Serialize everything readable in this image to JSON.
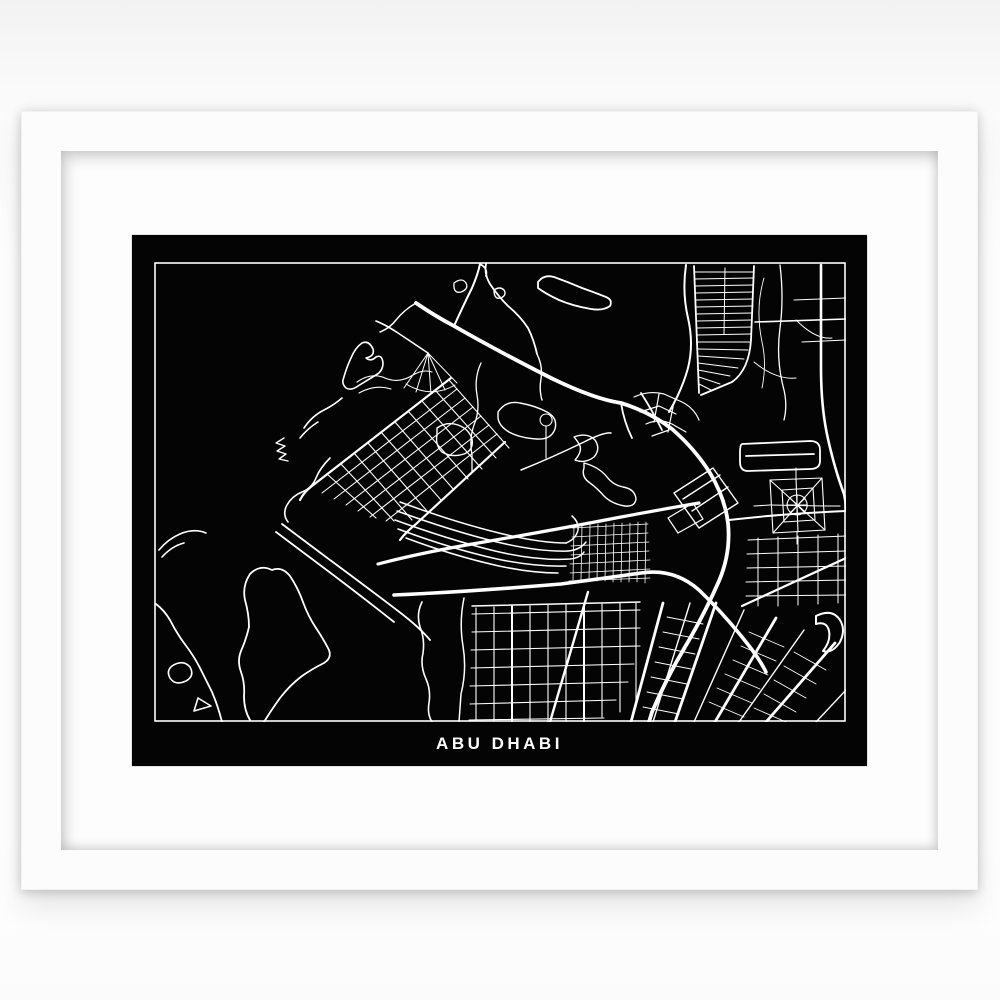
{
  "poster": {
    "title": "ABU DHABI",
    "background_color": "#040404",
    "line_color": "#ffffff"
  },
  "frame": {
    "frame_color": "#fcfcfc",
    "mat_color": "#fdfdfd",
    "wall_color": "#ffffff"
  },
  "map": {
    "border_color": "#ffffff",
    "strokes": [
      {
        "d": "M300,64 Q310,42 318,26 Q324,12 326,2",
        "w": 2
      },
      {
        "d": "M332,2 Q330,12 336,22 Q344,34 354,44 Q366,54 374,66 Q380,78 383,92 M326,2 Q334,6 332,14",
        "w": 1.8
      },
      {
        "d": "M384,20 Q390,12 400,15 Q414,20 428,26 Q442,31 452,35 Q459,38 456,44 Q449,49 437,47 Q419,44 405,38 Q392,32 384,26 Z",
        "w": 1.8
      },
      {
        "d": "M340,28 q6,-4 10,0 q3,5 -3,8 q-7,2 -7,-8 Z",
        "w": 1.4
      },
      {
        "d": "M383,92 Q389,104 387,117 Q385,128 388,138",
        "w": 1.4
      },
      {
        "d": "M150,166 Q158,154 170,148 Q180,143 188,136 M146,176 Q154,166 164,160",
        "w": 1.6
      },
      {
        "d": "M130,176 l-8,5 l9,3 l-8,5 l9,3 l-7,5 l9,2",
        "w": 1.4
      },
      {
        "d": "M176,196 Q166,206 162,216 Q158,226 148,230 Q138,234 133,243 Q128,252 134,260",
        "w": 1.6
      },
      {
        "d": "M5,288 Q14,277 26,272 Q40,266 52,271 M8,295 Q18,284 30,281",
        "w": 1.6
      },
      {
        "d": "M2,342 Q10,348 16,358 Q22,370 30,381 Q40,394 46,406 Q52,418 58,430 Q64,444 68,460",
        "w": 1.8
      },
      {
        "d": "M96,312 Q106,302 118,308 Q128,304 136,314 Q144,326 149,340 Q154,354 162,366 Q170,378 175,388 Q178,396 170,401 Q158,407 148,414 Q136,423 126,436 Q116,450 110,460 M96,312 Q88,324 91,338 Q95,352 95,365 Q92,378 87,389 Q83,399 87,410 Q91,421 90,434 Q90,448 96,458",
        "w": 1.8
      },
      {
        "d": "M18,404 q11,-7 18,1 q5,9 -4,14 q-11,5 -16,-3 q-4,-7 2,-12 Z",
        "w": 1.6
      },
      {
        "d": "M44,436 l13,8 l-17,5 Z",
        "w": 1.6
      },
      {
        "d": "M268,340 Q262,352 266,365 Q271,377 269,391 Q266,404 272,417 Q277,428 275,441 Q273,452 278,460",
        "w": 1.6
      },
      {
        "d": "M128,262 L172,295 Q214,326 248,352 Q266,366 276,378 M122,270 L166,303 Q206,333 240,360",
        "w": 1.8
      },
      {
        "d": "M189,118 Q193,104 197,96 Q201,86 208,81 Q215,78 219,87 Q221,94 212,96 Q217,100 222,95 Q228,92 229,101 Q229,109 222,113 Q212,119 204,124 Q197,129 192,126 Q188,122 189,118 Z",
        "w": 1.6
      },
      {
        "d": "M295,118 L160,222 M303,127 L168,231 M311,136 L180,237 M319,145 L192,243 M327,154 L204,249 M335,163 L216,255 M343,172 L232,259",
        "w": 1.1
      },
      {
        "d": "M297,116 L158,224 Q150,230 146,238",
        "w": 2.2
      },
      {
        "d": "M351,180 L262,262 Q252,270 246,278",
        "w": 2.2
      },
      {
        "d": "M295,118 L355,186 M281,128 L342,196 M268,139 L328,207 M254,149 L314,217 M241,160 L300,228 M227,170 L287,238 M214,181 L273,249 M200,191 L258,258 M187,202 L240,259 M173,212 L222,256",
        "w": 1.1
      },
      {
        "d": "M246,240 Q300,260 345,271 Q385,281 412,281",
        "w": 1.5
      },
      {
        "d": "M243,249 Q298,269 343,280 Q385,290 414,289",
        "w": 1.5
      },
      {
        "d": "M241,258 Q296,278 341,289 Q383,299 416,297 Q426,296 430,290",
        "w": 1.5
      },
      {
        "d": "M244,267 Q298,287 343,297 Q381,305 412,304",
        "w": 1.5
      },
      {
        "d": "M252,276 Q300,294 345,304 Q378,311 404,311",
        "w": 1.5
      },
      {
        "d": "M412,281 Q422,277 424,268 Q425,260 418,254 M414,289 Q426,288 432,280",
        "w": 1.5
      },
      {
        "d": "M344,150 Q352,138 366,141 Q382,144 393,150 Q404,156 401,167 Q397,178 383,177 Q366,176 355,170 Q345,164 344,156 Z",
        "w": 1.4
      },
      {
        "d": "M420,175 Q433,170 441,178 Q447,187 440,195 Q431,202 421,198 Q428,190 426,184 Q423,178 420,175 Z",
        "w": 1.4
      },
      {
        "d": "M430,201 Q445,205 453,215 Q459,223 469,225 Q481,227 482,237 Q481,245 471,244 Q458,242 450,234 Q443,226 436,221 Q427,215 430,206 Z",
        "w": 1.4
      },
      {
        "d": "M283,166 Q293,159 304,163 Q315,167 318,177 Q320,188 310,192 Q298,196 288,190 Q281,183 283,173 Z",
        "w": 1.4
      },
      {
        "d": "M327,101 Q320,116 323,133 Q326,149 320,163 Q315,177 318,193 L318,210",
        "w": 1.3
      },
      {
        "d": "M367,208 Q397,196 430,180 Q450,170 457,171",
        "w": 1.5
      },
      {
        "d": "M392,152 a6,6 0 1 0 0.2,0 M392,164 L392,196",
        "w": 1.1
      },
      {
        "d": "M520,231 L559,206 L584,241 L545,266 Z M529,237 L566,213 M538,249 L574,225",
        "w": 1.4
      },
      {
        "d": "M514,256 L539,241 L549,257 L524,271 Z",
        "w": 1.2
      },
      {
        "d": "M480,135 Q495,128 510,132 L528,140 Q540,146 545,158 M486,150 L505,144 L522,152 M492,162 Q505,156 518,162 L532,170 M498,174 L515,168 M505,132 L500,160 M520,140 L514,170",
        "w": 1.2
      },
      {
        "d": "M274,91 L250,126 M274,91 L262,130 M274,91 L277,132 M274,91 L291,128 M274,91 L303,121 M252,122 Q277,137 301,123",
        "w": 1
      },
      {
        "d": "M274,91 L244,71 Q232,63 222,59",
        "w": 1.6
      },
      {
        "d": "M203,120 Q217,110 231,116 Q245,122 259,113 Q269,107 278,110 M205,131 Q221,122 237,127",
        "w": 1.1
      },
      {
        "d": "M540,4 L545,131 M600,4 L597,78 Q595,108 578,120 L547,133",
        "w": 1.8
      },
      {
        "d": "M541,10 L599,10 M541,17 L599,16 M541,24 L599,23 M542,31 L599,30 M542,38 L599,37 M542,45 L599,44 M542,52 L598,51 M543,59 L598,58 M543,66 L598,65 M543,73 L597,72 M543,80 L596,80 M544,87 L594,88 M544,94 L590,97 M544,101 L584,106 M544,108 L576,114 M545,115 L566,122 M545,122 L557,128",
        "w": 1
      },
      {
        "d": "M571,6 L570,72",
        "w": 1
      },
      {
        "d": "M532,3 Q528,30 534,56 Q540,82 534,106 Q528,128 515,150",
        "w": 2
      },
      {
        "d": "M667,3 L667,106 Q667,146 674,177 Q681,208 690,232 Q692,240 692,248",
        "w": 2.6
      },
      {
        "d": "M626,3 Q630,36 626,66 Q622,96 629,124 Q634,142 630,158",
        "w": 1.3
      },
      {
        "d": "M601,60 L692,57",
        "w": 1.6
      },
      {
        "d": "M640,38 L692,36 M648,80 L692,78",
        "w": 1.1
      },
      {
        "d": "M610,16 Q601,46 608,80 Q613,102 608,126",
        "w": 0.9
      },
      {
        "d": "M600,100 Q622,118 642,116 M642,58 Q662,78 678,76",
        "w": 1
      },
      {
        "d": "M588,182 L656,179 Q666,179 666,188 L666,199 Q666,207 656,207 L594,209 Q586,209 586,200 L586,190 Q586,183 588,182 Z M592,194 L660,192",
        "w": 1.8
      },
      {
        "d": "M616,218 L668,216 L671,268 L619,271 Z M616,218 L671,268 M668,216 L619,271 M642,216 L644,270 M616,243 L670,244",
        "w": 1.1
      },
      {
        "d": "M628,228 L659,226 L661,258 L630,260 Z",
        "w": 1.1
      },
      {
        "d": "M643,233 a10,10 0 1 0 0.2,0 M643,233 L643,253 M633,243 L653,243 M636,236 L651,251 M651,236 L636,251",
        "w": 1.1
      },
      {
        "d": "M616,243 L600,244 M671,244 L686,244 M642,216 L642,206 M643,270 L643,282",
        "w": 1
      },
      {
        "d": "M594,278 L692,274 M593,292 L692,289 M593,306 L692,304 M592,320 L692,318 M592,334 L692,333",
        "w": 1
      },
      {
        "d": "M604,276 L604,344 M624,275 L624,344 M644,274 L644,343 M664,273 L664,342 M684,272 L684,341",
        "w": 1
      },
      {
        "d": "M588,344 L692,296",
        "w": 2.2
      },
      {
        "d": "M420,264 L419,318 M428,263 L427,318 M436,263 L435,319 M444,262 L443,319 M452,262 L451,319 M460,261 L459,320 M468,261 L467,320 M476,261 L475,320 M484,260 L483,320 M492,260 L491,321",
        "w": 0.8
      },
      {
        "d": "M418,266 L494,262 M418,275 L494,271 M417,284 L495,280 M417,293 L495,289 M416,302 L496,298 M416,311 L496,307 M415,319 L496,316",
        "w": 0.8
      },
      {
        "d": "M322,346 L322,458 M340,345 L340,459 M358,344 L358,460 M376,344 L376,460 M394,343 L394,460 M412,343 L412,460 M430,342 L430,460 M448,342 L448,455 M466,341 L466,450 M482,341 L482,444",
        "w": 1.1
      },
      {
        "d": "M318,352 L486,348 M318,370 L486,366 M317,388 L486,384 M317,406 L480,402 M316,424 L474,420 M316,442 L462,438 M315,458 L450,456",
        "w": 1.1
      },
      {
        "d": "M358,344 L358,460 M430,342 L430,460",
        "w": 2
      },
      {
        "d": "M434,330 L396,460",
        "w": 2.4
      },
      {
        "d": "M310,336 Q305,360 309,384 Q313,408 307,432 L305,460",
        "w": 1.5
      },
      {
        "d": "M318,344 L486,340",
        "w": 1.5
      },
      {
        "d": "M509,341 L477,460 M562,341 L521,460 M622,356 L561,460 M681,381 L612,460",
        "w": 2.8
      },
      {
        "d": "M536,341 L499,460 M590,348 L540,460 M650,368 L585,460 M692,428 L662,460",
        "w": 1.4
      },
      {
        "d": "M513,355 L549,362 M509,370 L545,377 M505,385 L541,392 M501,400 L537,407 M497,415 L533,422 M493,430 L529,437 M489,445 L525,452",
        "w": 0.9
      },
      {
        "d": "M595,370 L630,385 M587,384 L622,399 M579,398 L614,413 M571,412 L606,427 M563,426 L598,441 M555,440 L590,455",
        "w": 0.9
      },
      {
        "d": "M640,390 L672,408 M630,404 L662,422 M620,418 L652,436 M610,432 L642,450 M600,446 L632,460",
        "w": 0.9
      },
      {
        "d": "M662,354 Q678,346 686,358 Q692,368 686,380 Q678,392 669,389 Q677,379 675,369 Q673,359 662,362 Z",
        "w": 2
      },
      {
        "d": "M224,302 Q270,290 330,280 Q400,268 467,255 Q510,247 545,241",
        "w": 3.2
      },
      {
        "d": "M240,333 Q310,330 407,322 Q460,315 487,311 Q520,306 545,328 Q570,352 592,380 Q605,396 612,410",
        "w": 3.6
      },
      {
        "d": "M262,41 Q281,54 300,64 Q340,87 397,116 Q440,137 467,141 Q496,150 518,167 Q541,187 556,211 Q571,236 574,261 Q577,291 565,319 Q550,353 531,385 Q513,415 498,450 L495,460",
        "w": 3.8
      },
      {
        "d": "M487,131 Q498,148 508,168 M467,141 Q470,160 478,176",
        "w": 1.8
      },
      {
        "d": "M575,258 Q625,252 692,249",
        "w": 2
      },
      {
        "d": "M262,41 Q250,48 242,58 Q236,66 226,70",
        "w": 1.5
      },
      {
        "d": "M300,21 q8,-6 12,0 q3,6 -5,9 q-8,2 -7,-9 Z",
        "w": 1.3
      }
    ]
  }
}
